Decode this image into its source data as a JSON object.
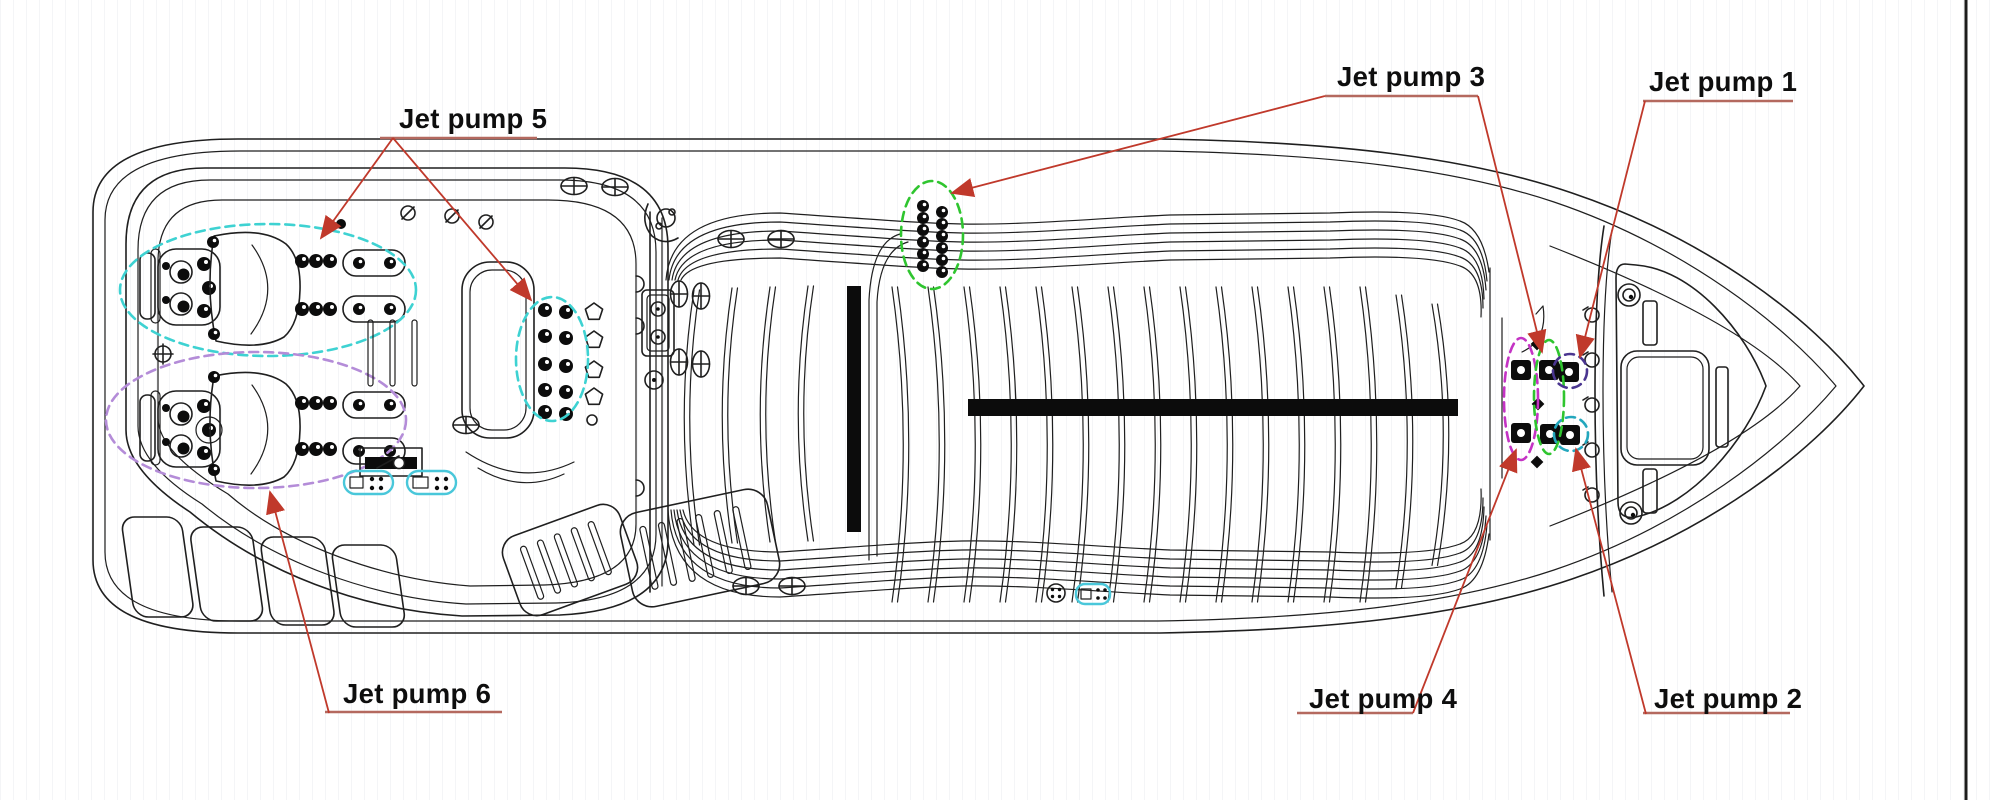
{
  "page": {
    "background": "#ffffff",
    "sheet_border_color": "#1c1c1c"
  },
  "drawing": {
    "subject": "Swim spa top view - jet pump locations",
    "line_color": "#1f1f1f",
    "annotation": {
      "text_color": "#0e0e0e",
      "leader_color": "#c0392b",
      "underline_color": "#b4695f"
    },
    "labels": {
      "jp1": {
        "text": "Jet pump 1"
      },
      "jp2": {
        "text": "Jet pump 2"
      },
      "jp3": {
        "text": "Jet pump 3"
      },
      "jp4": {
        "text": "Jet pump 4"
      },
      "jp5": {
        "text": "Jet pump 5"
      },
      "jp6": {
        "text": "Jet pump 6"
      }
    },
    "regions": {
      "jp1": {
        "outline": "#4a3590",
        "shape": "dashed-circle",
        "location": "stern jet, upper right"
      },
      "jp2": {
        "outline": "#23a7bd",
        "shape": "dashed-circle",
        "location": "stern jet, lower right"
      },
      "jp3": {
        "outline": "#2fc52f",
        "shape": "dashed-ellipse",
        "location": "mid-pool jet column and stern middle column"
      },
      "jp4": {
        "outline": "#c433c4",
        "shape": "dashed-ellipse",
        "location": "stern left jet column"
      },
      "jp5": {
        "outline": "#3ed2d2",
        "shape": "dashed-ellipse",
        "location": "upper lounge seat and bench jet column"
      },
      "jp6": {
        "outline": "#b48cd8",
        "shape": "dashed-ellipse",
        "location": "lower lounge seat"
      },
      "controls_highlight": "#49c7da"
    }
  }
}
